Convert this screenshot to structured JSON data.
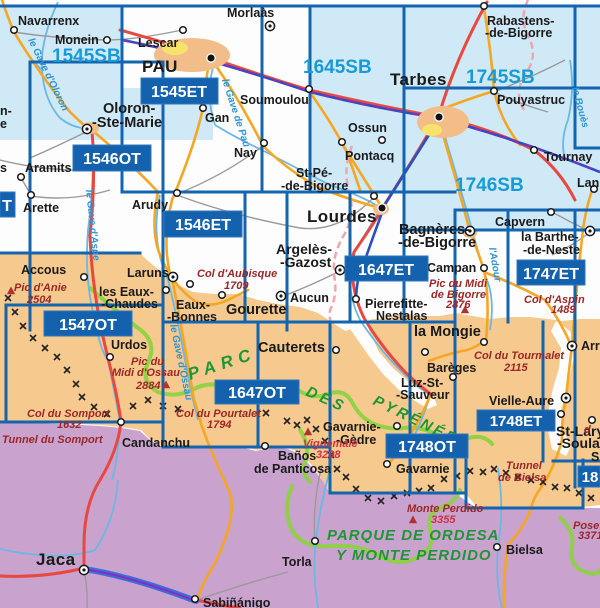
{
  "sheet_labels": {
    "s1545SB": "1545SB",
    "s1645SB": "1645SB",
    "s1745SB": "1745SB",
    "s1746SB": "1746SB",
    "s1545ET": "1545ET",
    "s1546OT": "1546OT",
    "s1546ET": "1546ET",
    "s1547OT": "1547OT",
    "s1647ET": "1647ET",
    "s1647OT": "1647OT",
    "s1747ET": "1747ET",
    "s1748ET": "1748ET",
    "s1748OT": "1748OT",
    "left_partial": "T",
    "right_partial": "18"
  },
  "towns": {
    "navarrenx": "Navarrenx",
    "monein": "Monein",
    "lescar": "Lescar",
    "pau": "PAU",
    "morlaas": "Morlaàs",
    "soumoulou": "Soumoulou",
    "gan": "Gan",
    "tarbes": "Tarbes",
    "rabastens_1": "Rabastens-",
    "rabastens_2": "-de-Bigorre",
    "pouyastruc": "Pouyastruc",
    "oloron_1": "Oloron-",
    "oloron_2": "-Ste-Marie",
    "aramits": "Aramits",
    "arette": "Arette",
    "arudy": "Arudy",
    "nay": "Nay",
    "ossun": "Ossun",
    "pontacq": "Pontacq",
    "st_pe_1": "St-Pé-",
    "st_pe_2": "-de-Bigorre",
    "lourdes": "Lourdes",
    "argeles_1": "Argelès-",
    "argeles_2": "-Gazost",
    "bagneres_1": "Bagnères-",
    "bagneres_2": "-de-Bigorre",
    "campan": "Campan",
    "capvern": "Capvern",
    "la_barthe_1": "la Barthe-",
    "la_barthe_2": "-de-Neste",
    "tournay": "Tournay",
    "lannemezan": "Lannemezan",
    "accous": "Accous",
    "laruns": "Laruns",
    "eaux_chaudes_1": "les Eaux-",
    "eaux_chaudes_2": "-Chaudes",
    "eaux_bonnes_1": "Eaux-",
    "eaux_bonnes_2": "-Bonnes",
    "gourette": "Gourette",
    "aucun": "Aucun",
    "pierrefitte_1": "Pierrefitte-",
    "pierrefitte_2": "Nestalas",
    "la_mongie": "la Mongie",
    "cauterets": "Cauterets",
    "bareges": "Barèges",
    "luz_1": "Luz-St-",
    "luz_2": "-Sauveur",
    "vielle_aure": "Vielle-Aure",
    "st_lary_1": "St-Lary",
    "st_lary_2": "-Soulan",
    "urdos": "Urdos",
    "candanchu": "Candanchu",
    "gavarnie_gedre_1": "Gavarnie-",
    "gavarnie_gedre_2": "-Gèdre",
    "gavarnie": "Gavarnie",
    "banos_1": "Baños",
    "banos_2": "de Panticosa",
    "torla": "Torla",
    "bielsa": "Bielsa",
    "jaca": "Jaca",
    "sabinanigo": "Sabiñánigo",
    "arreau": "Arreau",
    "fragment_left_1": "n-",
    "fragment_left_2": "e",
    "fragment_left_3": "s",
    "fragment_right_s": "S"
  },
  "peaks": {
    "pic_anie": "Pic d'Anie",
    "pic_anie_alt": "2504",
    "pic_ossau_1": "Pic du",
    "pic_ossau_2": "Midi d'Ossau",
    "pic_ossau_alt": "2884",
    "pic_bigorre_1": "Pic du Midi",
    "pic_bigorre_2": "de Bigorre",
    "pic_bigorre_alt": "2876",
    "vignemale": "Vignemale",
    "vignemale_alt": "3298",
    "monte_perdido": "Monte Perdido",
    "monte_perdido_alt": "3355",
    "posets": "Posets",
    "posets_alt": "3371"
  },
  "passes": {
    "aubisque": "Col d'Aubisque",
    "aubisque_alt": "1709",
    "somport": "Col du Somport",
    "somport_alt": "1632",
    "tunnel_somport": "Tunnel du Somport",
    "pourtalet": "Col du Pourtalet",
    "pourtalet_alt": "1794",
    "tourmalet": "Col du Tourmalet",
    "tourmalet_alt": "2115",
    "aspin": "Col d'Aspin",
    "aspin_alt": "1489",
    "tunnel_bielsa_1": "Tunnel",
    "tunnel_bielsa_2": "de Bielsa",
    "fragment_d": "d"
  },
  "parks": {
    "parc": "PARC",
    "des": "DES",
    "pyrenees": "PYRÉNÉES",
    "ordesa_1": "PARQUE DE ORDESA",
    "ordesa_2": "Y MONTE PERDIDO"
  },
  "rivers": {
    "gave_oloron": "le Gave d'Oloron",
    "gave_pau": "le Gave de Pau",
    "gave_aspe": "le Gave d'Aspe",
    "gave_ossau": "le Gave d'Ossau",
    "adour": "l'Adour",
    "boues": "le Bouès"
  },
  "colors": {
    "sheet_line": "#1465af",
    "sheet_box": "#1462ae",
    "sb_text": "#189ad6",
    "lowland_tint": "#cfe9f7",
    "terrain": "#f6c98e",
    "spain": "#c9a2ce",
    "park_line": "#8ad23e",
    "park_text": "#1e9633",
    "peak_text": "#9b2727",
    "river": "#6cb7e4",
    "road_red": "#e8483f",
    "road_orange": "#f5a623",
    "railway": "#2b4fc2",
    "motorway": "#3a6fd8"
  }
}
